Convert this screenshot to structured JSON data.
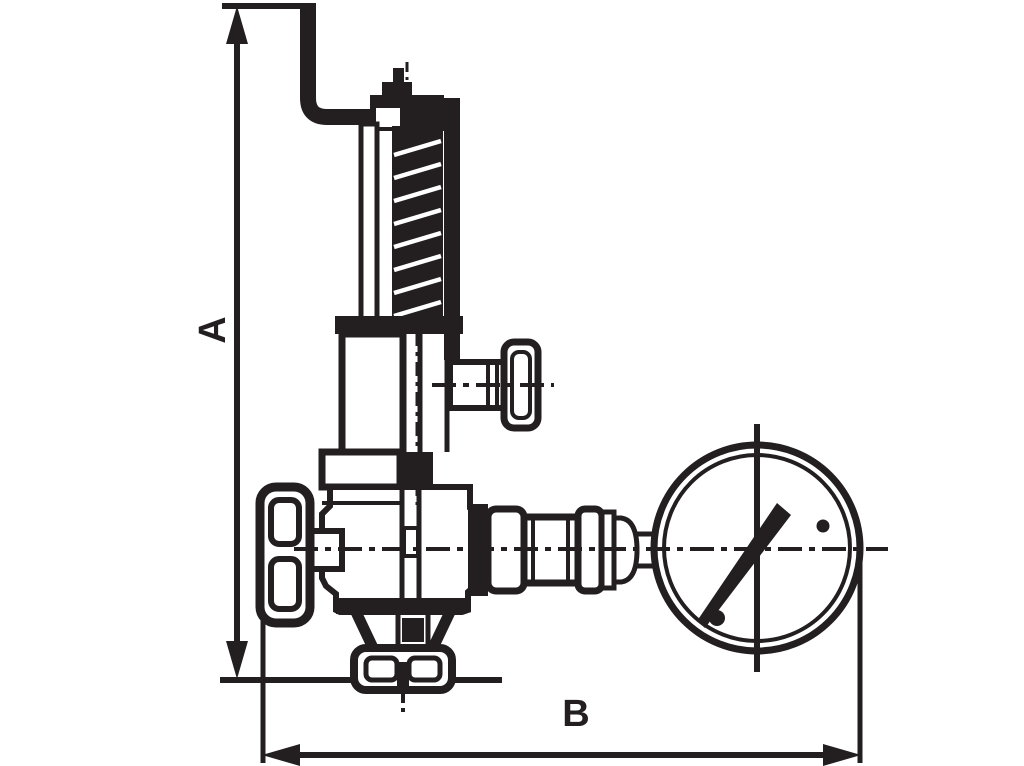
{
  "page": {
    "width": 1024,
    "height": 766,
    "background_color": "#ffffff",
    "ink_color": "#231f20"
  },
  "drawing": {
    "type": "technical-dimension-drawing",
    "view": "side elevation line drawing",
    "subject": "spring-loaded overflow/safety valve with mounting bracket, two side handwheels, bottom outlet flange and connected pressure gauge",
    "dimension_labels": {
      "a": {
        "text": "A",
        "axis": "vertical",
        "position": "left edge",
        "measures": "overall height from bracket top to outlet base plane"
      },
      "b": {
        "text": "B",
        "axis": "horizontal",
        "position": "bottom edge",
        "measures": "overall width from handwheel face to gauge outer edge"
      }
    },
    "parts": [
      "mounting-bracket",
      "adjusting-stem-tip",
      "adjusting-nut",
      "spring-cap",
      "yoke-post",
      "coil-spring",
      "spring-housing",
      "housing-flange",
      "bonnet-flange",
      "valve-body",
      "side-branch-pipe",
      "side-handwheel",
      "front-handwheel",
      "handwheel-stem",
      "outlet-funnel",
      "outlet-flange",
      "union-fitting",
      "coupling-nut",
      "gauge-connector-bell",
      "gauge-nipple",
      "pressure-gauge",
      "gauge-needle",
      "gauge-pivot-dots",
      "center-lines",
      "dimension-arrows"
    ]
  }
}
